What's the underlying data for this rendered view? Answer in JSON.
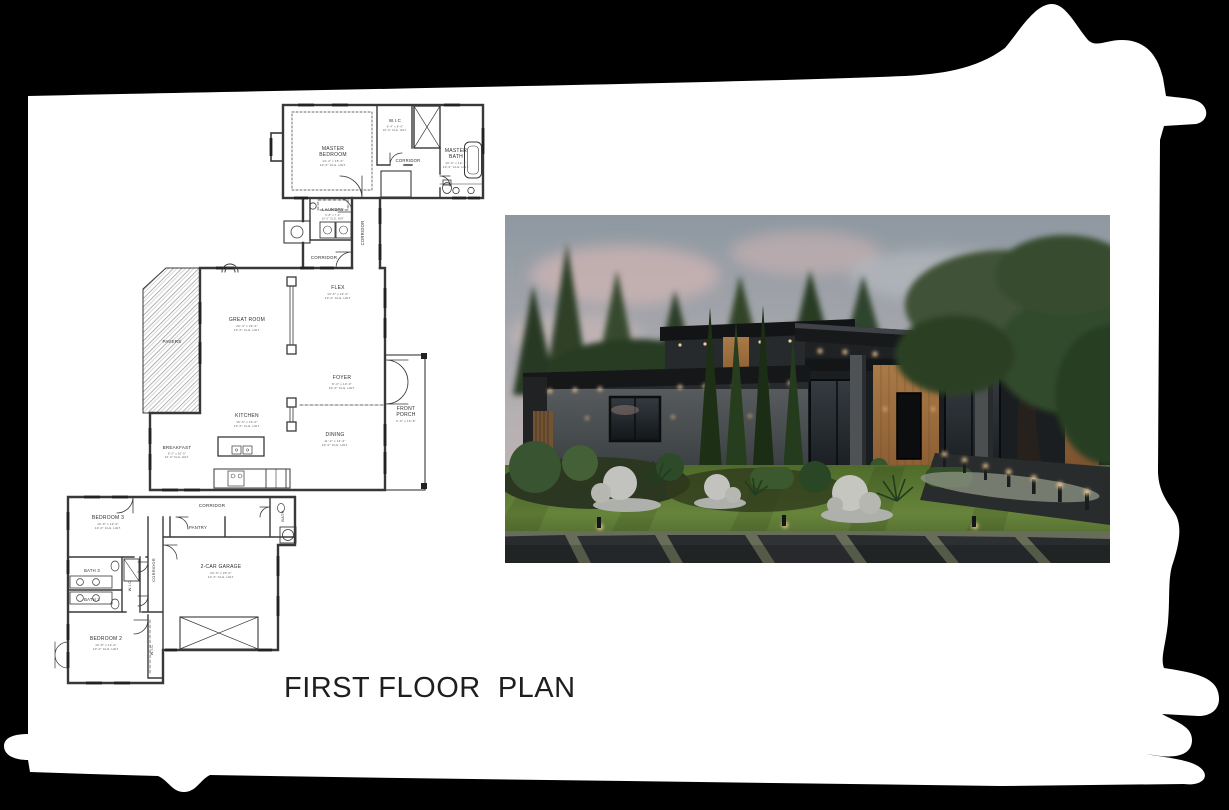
{
  "page": {
    "background": "#000000",
    "paper": "#ffffff"
  },
  "title": {
    "text": "FIRST FLOOR  PLAN"
  },
  "floor_plan": {
    "ink": "#383838",
    "rooms": [
      {
        "id": "master-bedroom",
        "lines": [
          "MASTER",
          "BEDROOM"
        ],
        "dims": [
          "13'-4\" x 15'-0\"",
          "10'-0\" CLG. HGT."
        ],
        "x": 333,
        "y": 150,
        "size": 5
      },
      {
        "id": "wic-master",
        "lines": [
          "W.I.C"
        ],
        "dims": [
          "6'-4\" x 9'-0\"",
          "10'-0\" CLG. HGT."
        ],
        "x": 395,
        "y": 122,
        "size": 4.5
      },
      {
        "id": "corridor-master",
        "lines": [
          "CORRIDOR"
        ],
        "x": 408,
        "y": 162,
        "size": 4.2
      },
      {
        "id": "master-bath",
        "lines": [
          "MASTER",
          "BATH"
        ],
        "dims": [
          "10'-0\" x 13'-2\"",
          "10'-0\" CLG. HGT."
        ],
        "x": 456,
        "y": 152,
        "size": 5
      },
      {
        "id": "laundry",
        "lines": [
          "LAUNDRY"
        ],
        "dims": [
          "6'-8\" x 7'-4\"",
          "10'-0\" CLG. HGT."
        ],
        "x": 333,
        "y": 211,
        "size": 4.2
      },
      {
        "id": "corridor-link-vertical",
        "lines": [
          "CORRIDOR"
        ],
        "x": 364,
        "y": 233,
        "rot": -90,
        "size": 4.2
      },
      {
        "id": "corridor-link",
        "lines": [
          "CORRIDOR"
        ],
        "x": 324,
        "y": 259,
        "size": 4.5
      },
      {
        "id": "flex",
        "lines": [
          "FLEX"
        ],
        "dims": [
          "13'-6\" x 13'-0\"",
          "10'-0\" CLG. HGT."
        ],
        "x": 338,
        "y": 289,
        "size": 5
      },
      {
        "id": "great-room",
        "lines": [
          "GREAT ROOM"
        ],
        "dims": [
          "20'-4\" x 23'-0\"",
          "10'-0\" CLG. HGT."
        ],
        "x": 247,
        "y": 321,
        "size": 5
      },
      {
        "id": "pavers",
        "lines": [
          "PAVERS"
        ],
        "x": 172,
        "y": 343,
        "size": 4.5
      },
      {
        "id": "foyer",
        "lines": [
          "FOYER"
        ],
        "dims": [
          "8'-4\" x 10'-0\"",
          "10'-0\" CLG. HGT."
        ],
        "x": 342,
        "y": 379,
        "size": 5
      },
      {
        "id": "front-porch",
        "lines": [
          "FRONT",
          "PORCH"
        ],
        "dims": [
          "6'-0\" x 16'-8\""
        ],
        "x": 406,
        "y": 410,
        "size": 5
      },
      {
        "id": "kitchen",
        "lines": [
          "KITCHEN"
        ],
        "dims": [
          "10'-6\" x 16'-0\"",
          "10'-0\" CLG. HGT."
        ],
        "x": 247,
        "y": 417,
        "size": 5
      },
      {
        "id": "dining",
        "lines": [
          "DINING"
        ],
        "dims": [
          "11'-4\" x 13'-6\"",
          "10'-0\" CLG. HGT."
        ],
        "x": 335,
        "y": 436,
        "size": 5
      },
      {
        "id": "breakfast",
        "lines": [
          "BREAKFAST"
        ],
        "dims": [
          "8'-2\" x 10'-0\"",
          "10'-0\" CLG. HGT."
        ],
        "x": 177,
        "y": 449,
        "size": 4.5
      },
      {
        "id": "corridor-lower",
        "lines": [
          "CORRIDOR"
        ],
        "x": 212,
        "y": 507,
        "size": 4.5
      },
      {
        "id": "bedroom-3",
        "lines": [
          "BEDROOM 3"
        ],
        "dims": [
          "10'-8\" x 12'-0\"",
          "10'-0\" CLG. HGT."
        ],
        "x": 108,
        "y": 519,
        "size": 5
      },
      {
        "id": "pantry",
        "lines": [
          "PANTRY"
        ],
        "x": 198,
        "y": 529,
        "size": 4.2
      },
      {
        "id": "bath",
        "lines": [
          "BATH"
        ],
        "x": 284,
        "y": 516,
        "rot": -90,
        "size": 4
      },
      {
        "id": "bath-3",
        "lines": [
          "BATH 3"
        ],
        "x": 92,
        "y": 572,
        "size": 4.2
      },
      {
        "id": "corridor-lower-vertical",
        "lines": [
          "CORRIDOR"
        ],
        "x": 155,
        "y": 570,
        "rot": -90,
        "size": 4
      },
      {
        "id": "wic-hall",
        "lines": [
          "W.I.C"
        ],
        "x": 131,
        "y": 586,
        "rot": -90,
        "size": 3.8
      },
      {
        "id": "bath-2",
        "lines": [
          "BATH 2"
        ],
        "x": 92,
        "y": 601,
        "size": 4.2
      },
      {
        "id": "garage",
        "lines": [
          "2-CAR GARAGE"
        ],
        "dims": [
          "20'-0\" x 20'-0\"",
          "10'-0\" CLG. HGT."
        ],
        "x": 221,
        "y": 568,
        "size": 5
      },
      {
        "id": "bedroom-2",
        "lines": [
          "BEDROOM 2"
        ],
        "dims": [
          "10'-8\" x 12'-0\"",
          "10'-0\" CLG. HGT."
        ],
        "x": 106,
        "y": 640,
        "size": 5
      },
      {
        "id": "wic-bedroom-2",
        "lines": [
          "W.I.C"
        ],
        "x": 153,
        "y": 650,
        "rot": -90,
        "size": 3.8
      }
    ]
  },
  "render_photo": {
    "palette": {
      "sky": "#a2acb4",
      "clouds_pink": "#e5c3c1",
      "trees": "#2c4026",
      "grass": "#5f7f37",
      "house": "#232628",
      "wood_accent": "#a9743f",
      "warm_light": "#ffd9a2",
      "walkway": "#24272a",
      "spheres": "#cfd0ca"
    }
  }
}
